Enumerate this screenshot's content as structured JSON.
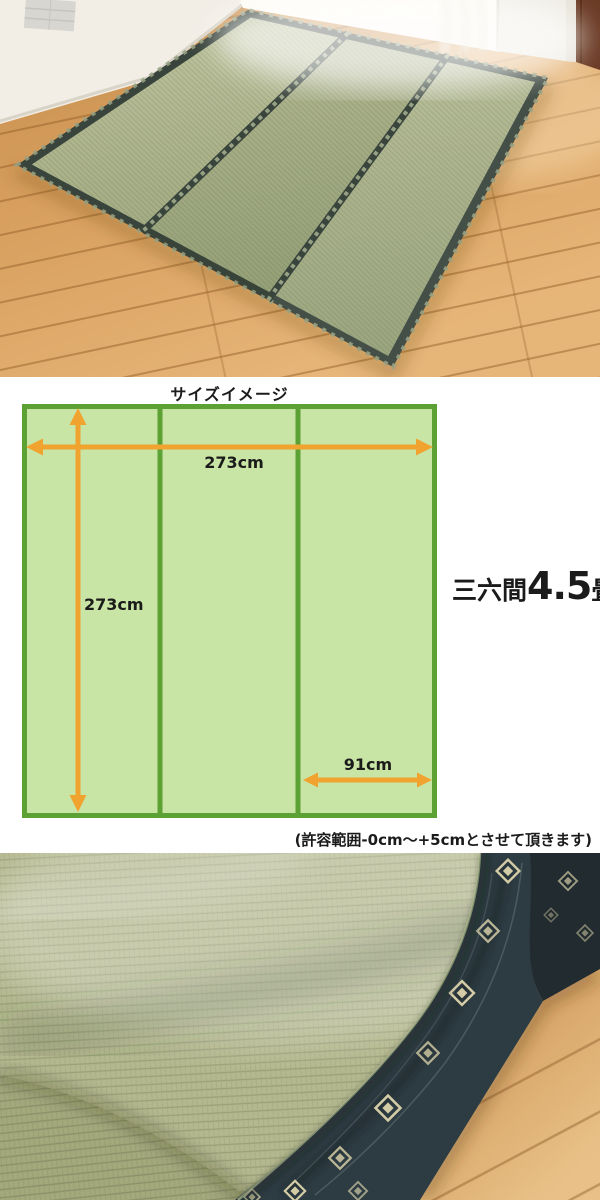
{
  "size_diagram": {
    "title": "サイズイメージ",
    "width_label": "273cm",
    "height_label": "273cm",
    "panel_width_label": "91cm",
    "size_name": {
      "prefix": "三六間",
      "value": "4.5",
      "unit": "畳"
    },
    "tolerance_note": "(許容範囲-0cm〜+5cmとさせて頂きます)",
    "colors": {
      "mat_fill": "#c9e5a5",
      "mat_border": "#5ba134",
      "arrow": "#f0a32f",
      "text": "#1b1b1b"
    }
  },
  "photos": {
    "room": {
      "name": "room-photo-rug-in-room",
      "colors": {
        "rug_green": "#a9b189",
        "rug_binding": "#3a453e",
        "floor_wood": "#d89f5e",
        "wall": "#f2eee6",
        "door": "#6a3a24"
      }
    },
    "closeup": {
      "name": "fabric-closeup-photo-folded-rug",
      "colors": {
        "mat_green": "#b4b88e",
        "binding_navy": "#2d3b42",
        "motif_cream": "#d3cca6",
        "floor_wood": "#d59c5c"
      }
    }
  }
}
